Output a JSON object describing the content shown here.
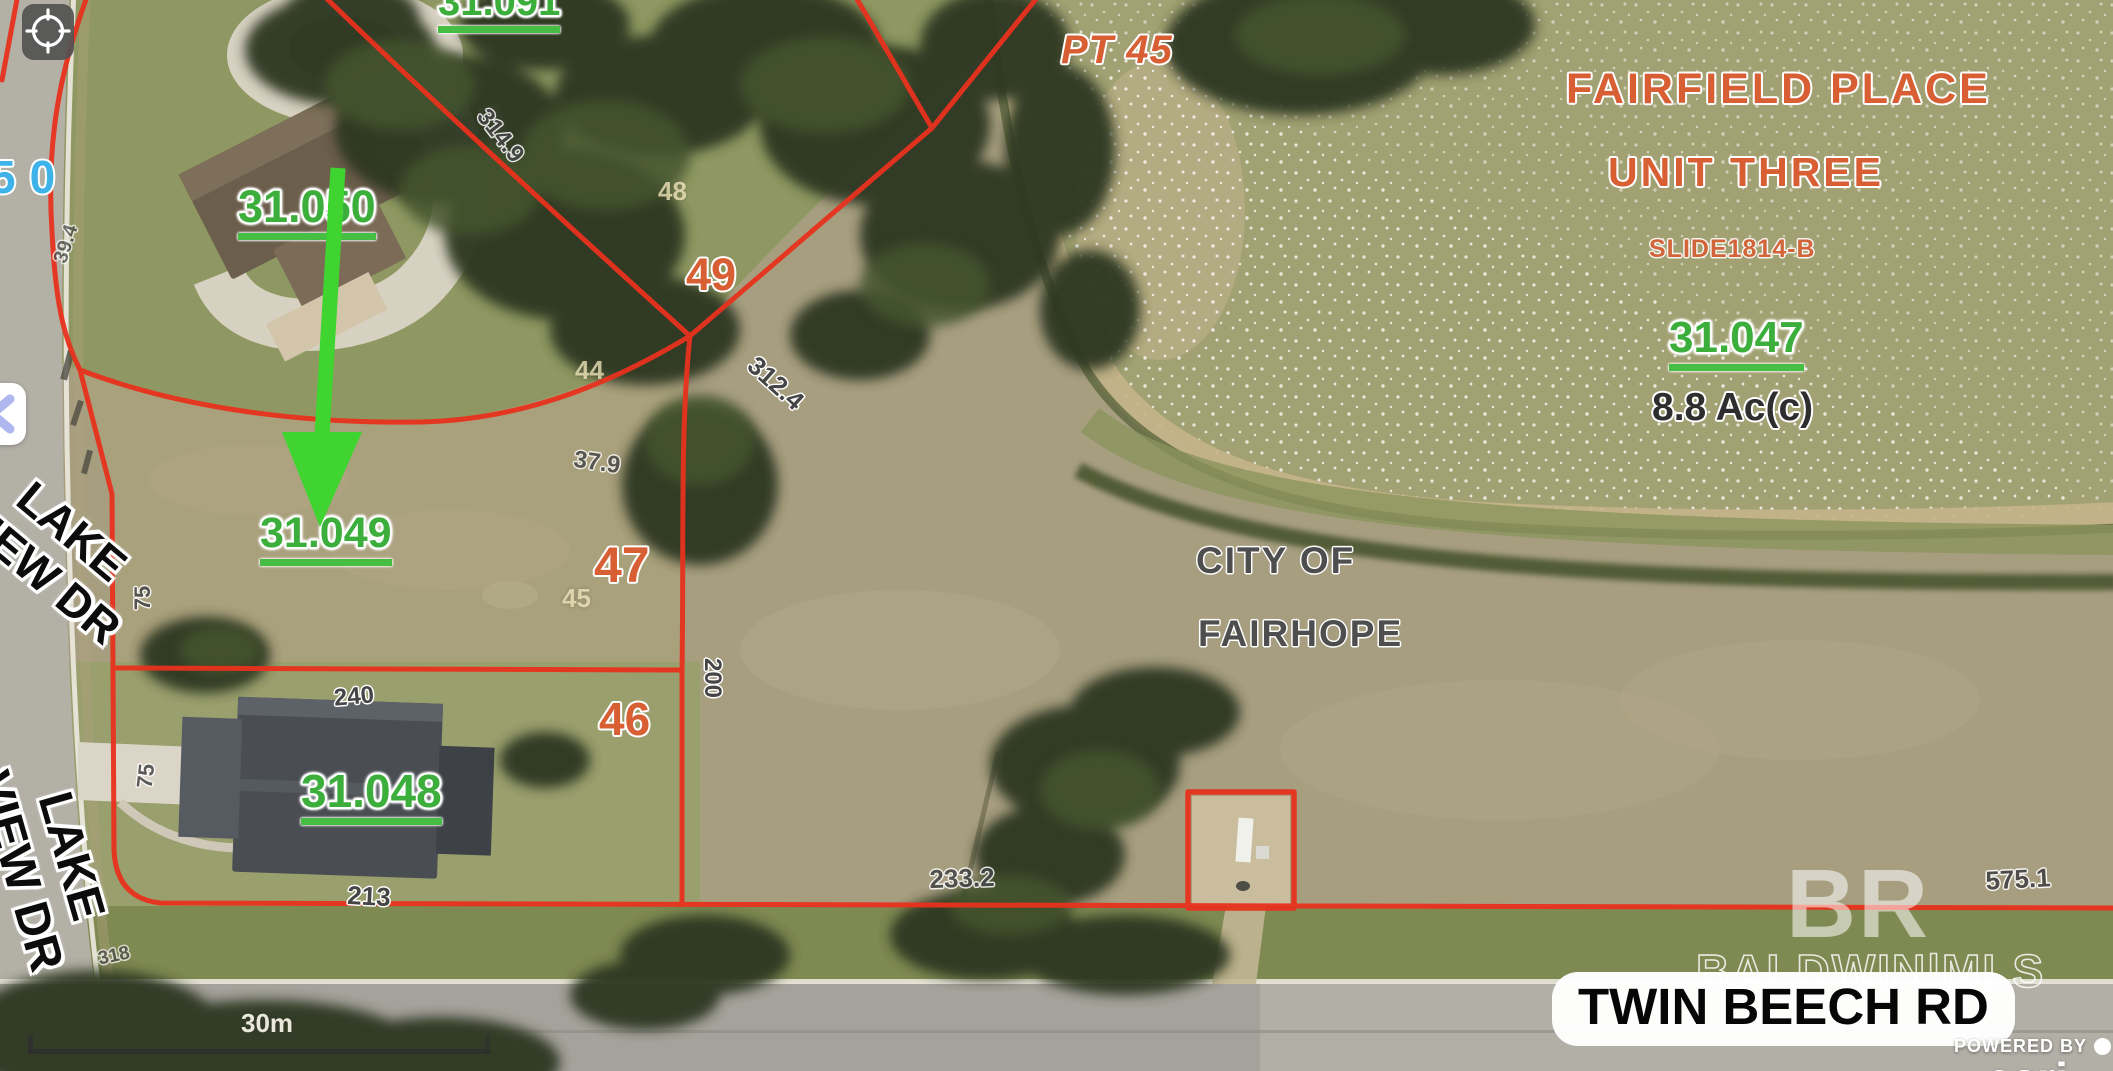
{
  "map_controls": {
    "compass_button": "compass",
    "collapse_button": "collapse-panel"
  },
  "overlay": {
    "subdivision_title": [
      "FAIRFIELD PLACE",
      "UNIT THREE",
      "SLIDE1814-B"
    ],
    "city_label": [
      "CITY OF",
      "FAIRHOPE"
    ],
    "parcels": [
      {
        "id": "31.091"
      },
      {
        "id": "31.050"
      },
      {
        "id": "31.049",
        "highlighted": true
      },
      {
        "id": "31.048"
      },
      {
        "id": "31.047",
        "acreage": "8.8 Ac(c)"
      }
    ],
    "lots": [
      "PT 45",
      "49",
      "47",
      "46"
    ],
    "house_number": "50",
    "dimensions": [
      "314.9",
      "312.4",
      "37.9",
      "240",
      "200",
      "75",
      "75",
      "213",
      "233.2",
      "575.1",
      "318",
      "39.4"
    ],
    "plat_numbers": [
      "48",
      "44",
      "45"
    ],
    "streets": {
      "lake_view_line1": "LAKE",
      "lake_view_line2": "VIEW DR",
      "twin_beech": "TWIN BEECH RD"
    },
    "scale_label": "30m",
    "watermarks": {
      "logo": "BR",
      "mls": "BALDWIN|MLS",
      "powered_by": "POWERED BY",
      "brand": "esri"
    }
  },
  "colors": {
    "parcel_line": "#e8321e",
    "parcel_label_green": "#3cae3b",
    "lot_label_orange": "#d85e33",
    "dimension_gray": "#454545",
    "address_blue": "#3eb3e9",
    "arrow_green": "#3fd430"
  }
}
